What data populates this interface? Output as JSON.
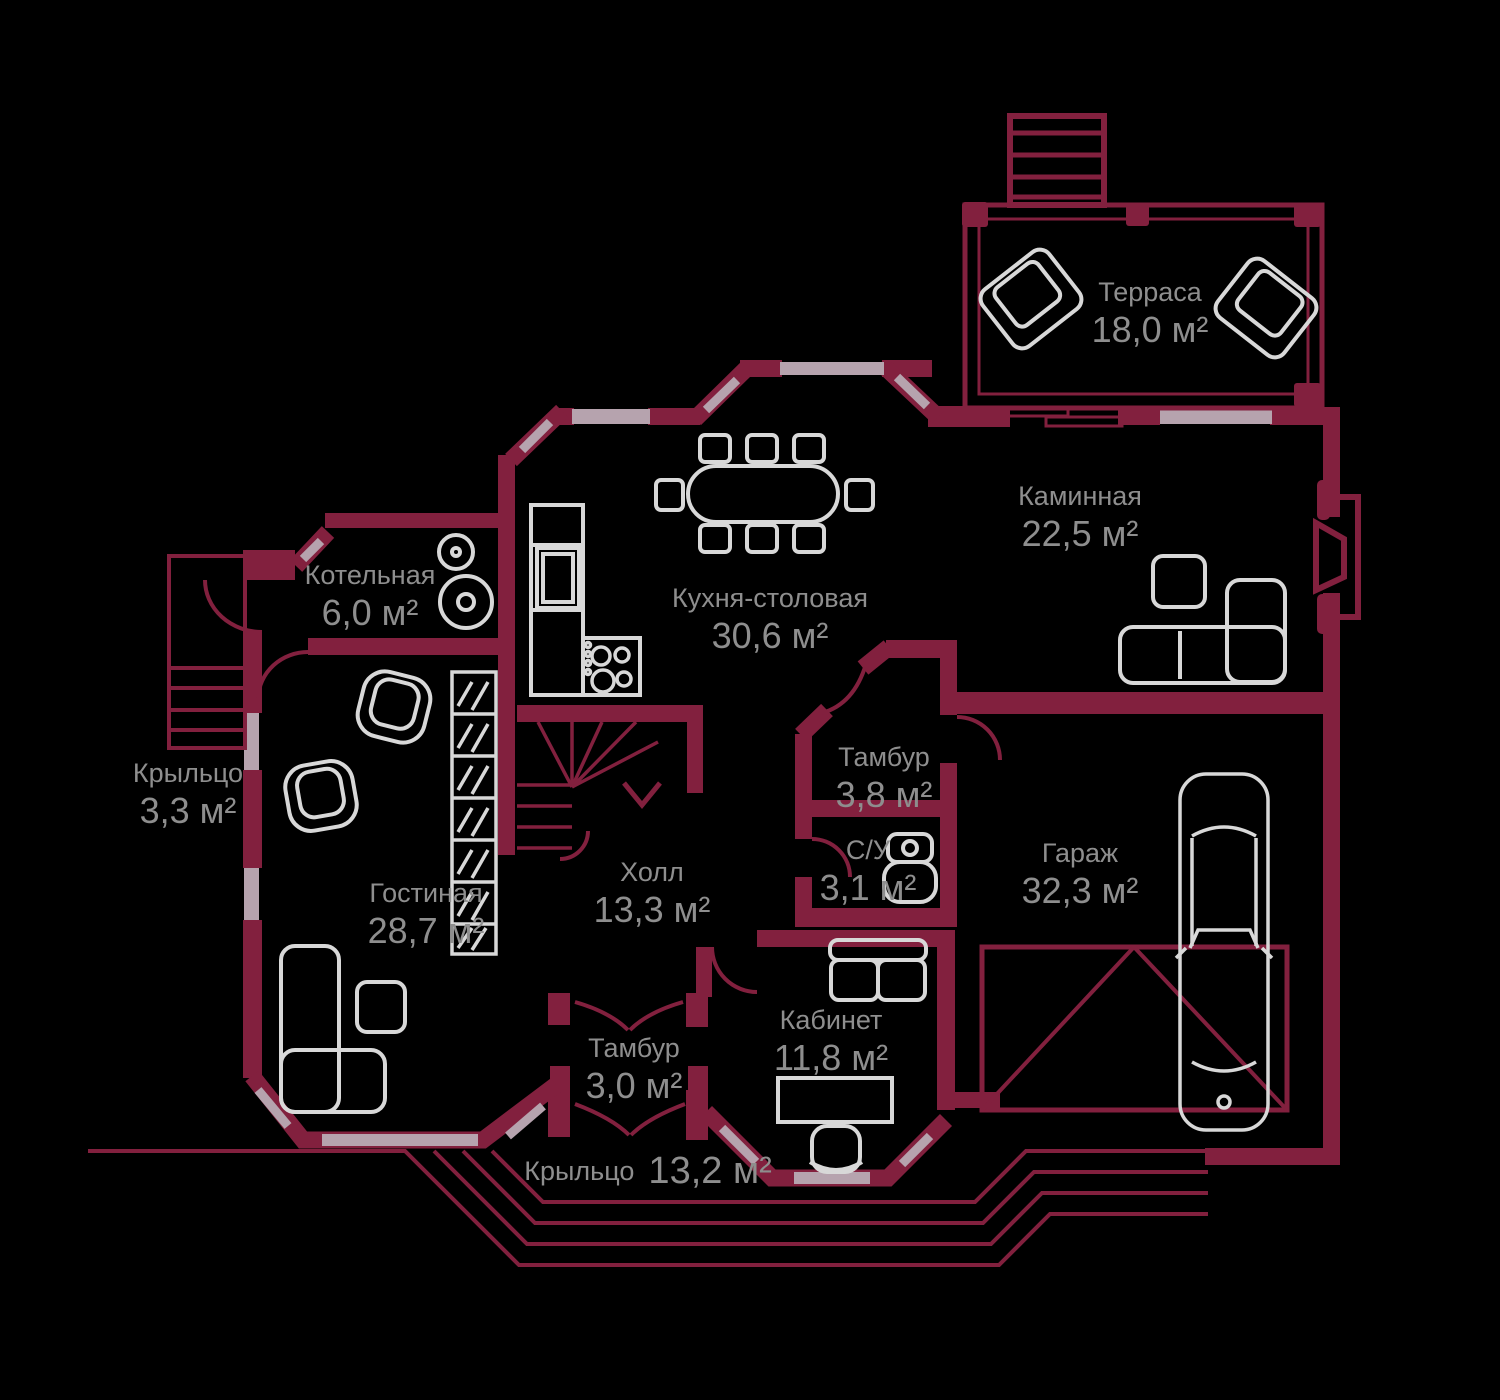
{
  "plan": {
    "floor_title": "План первого этажа",
    "units": "м²"
  },
  "colors": {
    "wall": "#82203e",
    "window": "#b6a3ae",
    "furniture": "#d8d8d8",
    "label_text": "#8e8e8e",
    "background": "#000000"
  },
  "rooms": [
    {
      "id": "terrace",
      "name": "Терраса",
      "area": "18,0 м²"
    },
    {
      "id": "fireplace-room",
      "name": "Каминная",
      "area": "22,5 м²"
    },
    {
      "id": "kitchen-dining",
      "name": "Кухня-столовая",
      "area": "30,6 м²"
    },
    {
      "id": "boiler-room",
      "name": "Котельная",
      "area": "6,0 м²"
    },
    {
      "id": "porch-left",
      "name": "Крыльцо",
      "area": "3,3 м²"
    },
    {
      "id": "living-room",
      "name": "Гостиная",
      "area": "28,7 м²"
    },
    {
      "id": "hall",
      "name": "Холл",
      "area": "13,3 м²"
    },
    {
      "id": "vestibule-top",
      "name": "Тамбур",
      "area": "3,8 м²"
    },
    {
      "id": "bathroom",
      "name": "С/У",
      "area": "3,1 м²"
    },
    {
      "id": "garage",
      "name": "Гараж",
      "area": "32,3 м²"
    },
    {
      "id": "vestibule-bottom",
      "name": "Тамбур",
      "area": "3,0 м²"
    },
    {
      "id": "study",
      "name": "Кабинет",
      "area": "11,8 м²"
    },
    {
      "id": "porch-front",
      "name": "Крыльцо",
      "area": "13,2 м²"
    }
  ]
}
